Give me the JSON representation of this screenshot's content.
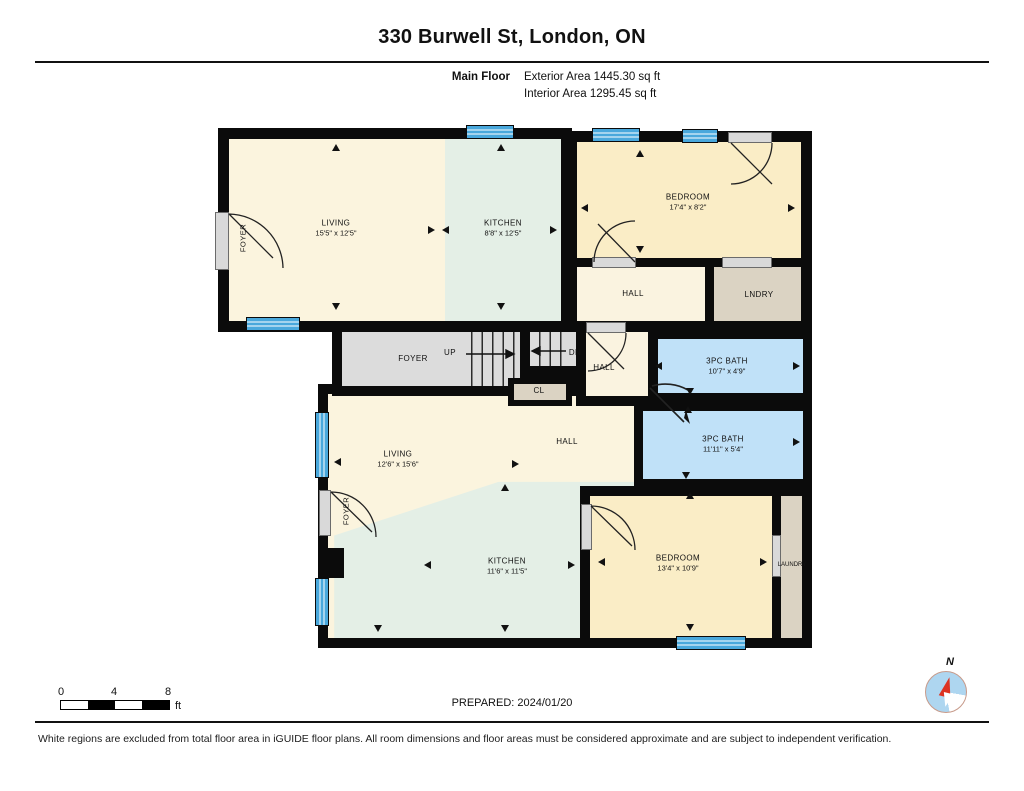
{
  "header": {
    "title": "330 Burwell St, London, ON",
    "floor_label": "Main Floor",
    "exterior_area": "Exterior Area 1445.30 sq ft",
    "interior_area": "Interior Area 1295.45 sq ft"
  },
  "rooms": {
    "living_upper": {
      "name": "LIVING",
      "dims": "15'5\" x 12'5\""
    },
    "kitchen_upper": {
      "name": "KITCHEN",
      "dims": "8'8\" x 12'5\""
    },
    "bedroom_upper": {
      "name": "BEDROOM",
      "dims": "17'4\" x 8'2\""
    },
    "hall_upper": {
      "name": "HALL"
    },
    "laundry_upper": {
      "name": "LNDRY"
    },
    "foyer_upper": {
      "name": "FOYER"
    },
    "stairs_up": {
      "name": "UP"
    },
    "stairs_down": {
      "name": "DN"
    },
    "hall_mid": {
      "name": "HALL"
    },
    "closet": {
      "name": "CL"
    },
    "bath_upper": {
      "name": "3PC BATH",
      "dims": "10'7\" x 4'9\""
    },
    "bath_lower": {
      "name": "3PC BATH",
      "dims": "11'11\" x 5'4\""
    },
    "living_lower": {
      "name": "LIVING",
      "dims": "12'6\" x 15'6\""
    },
    "hall_lower": {
      "name": "HALL"
    },
    "kitchen_lower": {
      "name": "KITCHEN",
      "dims": "11'6\" x 11'5\""
    },
    "foyer_lower": {
      "name": "FOYER"
    },
    "bedroom_lower": {
      "name": "BEDROOM",
      "dims": "13'4\" x 10'9\""
    },
    "laundry_lower": {
      "name": "LAUNDRY"
    }
  },
  "scale_bar": {
    "tick0": "0",
    "tick1": "4",
    "tick2": "8",
    "unit": "ft"
  },
  "compass": {
    "north_label": "N"
  },
  "footer": {
    "prepared": "PREPARED: 2024/01/20",
    "disclaimer": "White regions are excluded from total floor area in iGUIDE floor plans. All room dimensions and floor areas must be considered approximate and are subject to independent verification."
  },
  "colors": {
    "wall": "#0b0b0b",
    "living_cream": "#FBF4DE",
    "bedroom_yellow": "#FAEDC6",
    "kitchen_mint": "#E4EFE6",
    "bath_blue": "#C0E1F8",
    "laundry_tan": "#DBD3C3",
    "stairs_gray": "#DCDCDC",
    "window_blue": "#49A8DC",
    "compass_red": "#D32",
    "compass_blue": "#AED6F0"
  }
}
